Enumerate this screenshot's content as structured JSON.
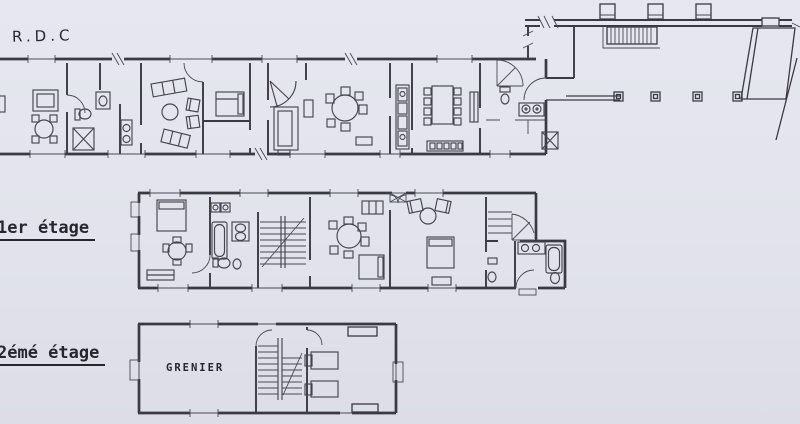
{
  "document": {
    "kind": "scanned architectural floor plan",
    "colors": {
      "paper": "#e2e3ec",
      "ink": "#3a3a45",
      "text": "#26262e"
    }
  },
  "floors": {
    "ground": {
      "label": "R.D.C"
    },
    "first": {
      "label": "1er étage"
    },
    "second": {
      "label": "2émé étage",
      "room_label": "GRENIER"
    }
  }
}
